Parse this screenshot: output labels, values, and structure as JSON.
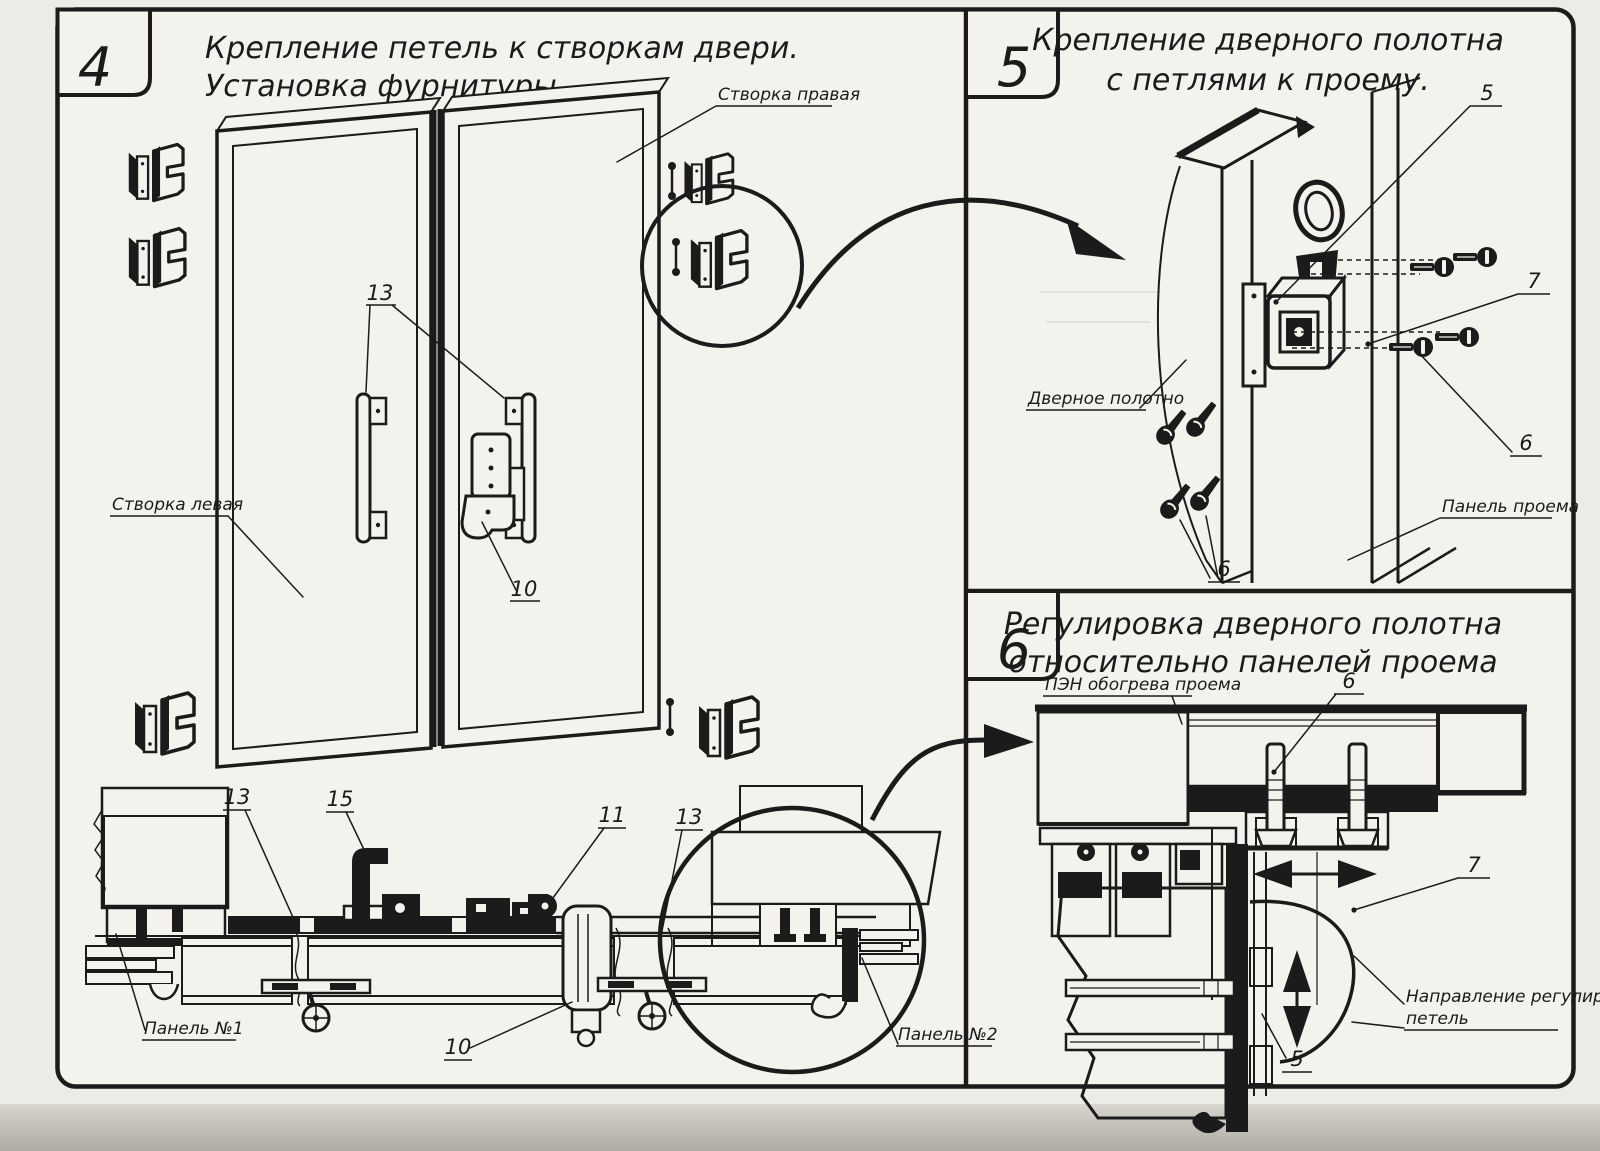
{
  "sheet": {
    "panels": {
      "p4": {
        "number": "4",
        "title": [
          "Крепление петель к створкам двери.",
          "Установка фурнитуры."
        ],
        "labels": {
          "leaf_right": "Створка правая",
          "leaf_left": "Створка левая",
          "panel1": "Панель №1",
          "panel2": "Панель №2"
        },
        "callouts": {
          "handles": "13",
          "latch": "10",
          "section_frame": "13",
          "section_handle": "15",
          "section_roller": "11",
          "section_joint": "13",
          "section_lock": "10"
        }
      },
      "p5": {
        "number": "5",
        "title": [
          "Крепление дверного полотна",
          "с петлями к проему."
        ],
        "labels": {
          "door_leaf": "Дверное полотно",
          "opening_panel": "Панель проема"
        },
        "callouts": {
          "hinge": "5",
          "adjust_screw": "7",
          "fix_screw": "6",
          "anchor_bolts": "6"
        }
      },
      "p6": {
        "number": "6",
        "title": [
          "Регулировка дверного полотна",
          "относительно панелей проема"
        ],
        "labels": {
          "heater": "ПЭН обогрева проема",
          "direction_line1": "Направление регулировки",
          "direction_line2": "петель"
        },
        "callouts": {
          "bolt": "6",
          "hinge_side": "7",
          "hinge_bottom": "5"
        }
      }
    }
  }
}
